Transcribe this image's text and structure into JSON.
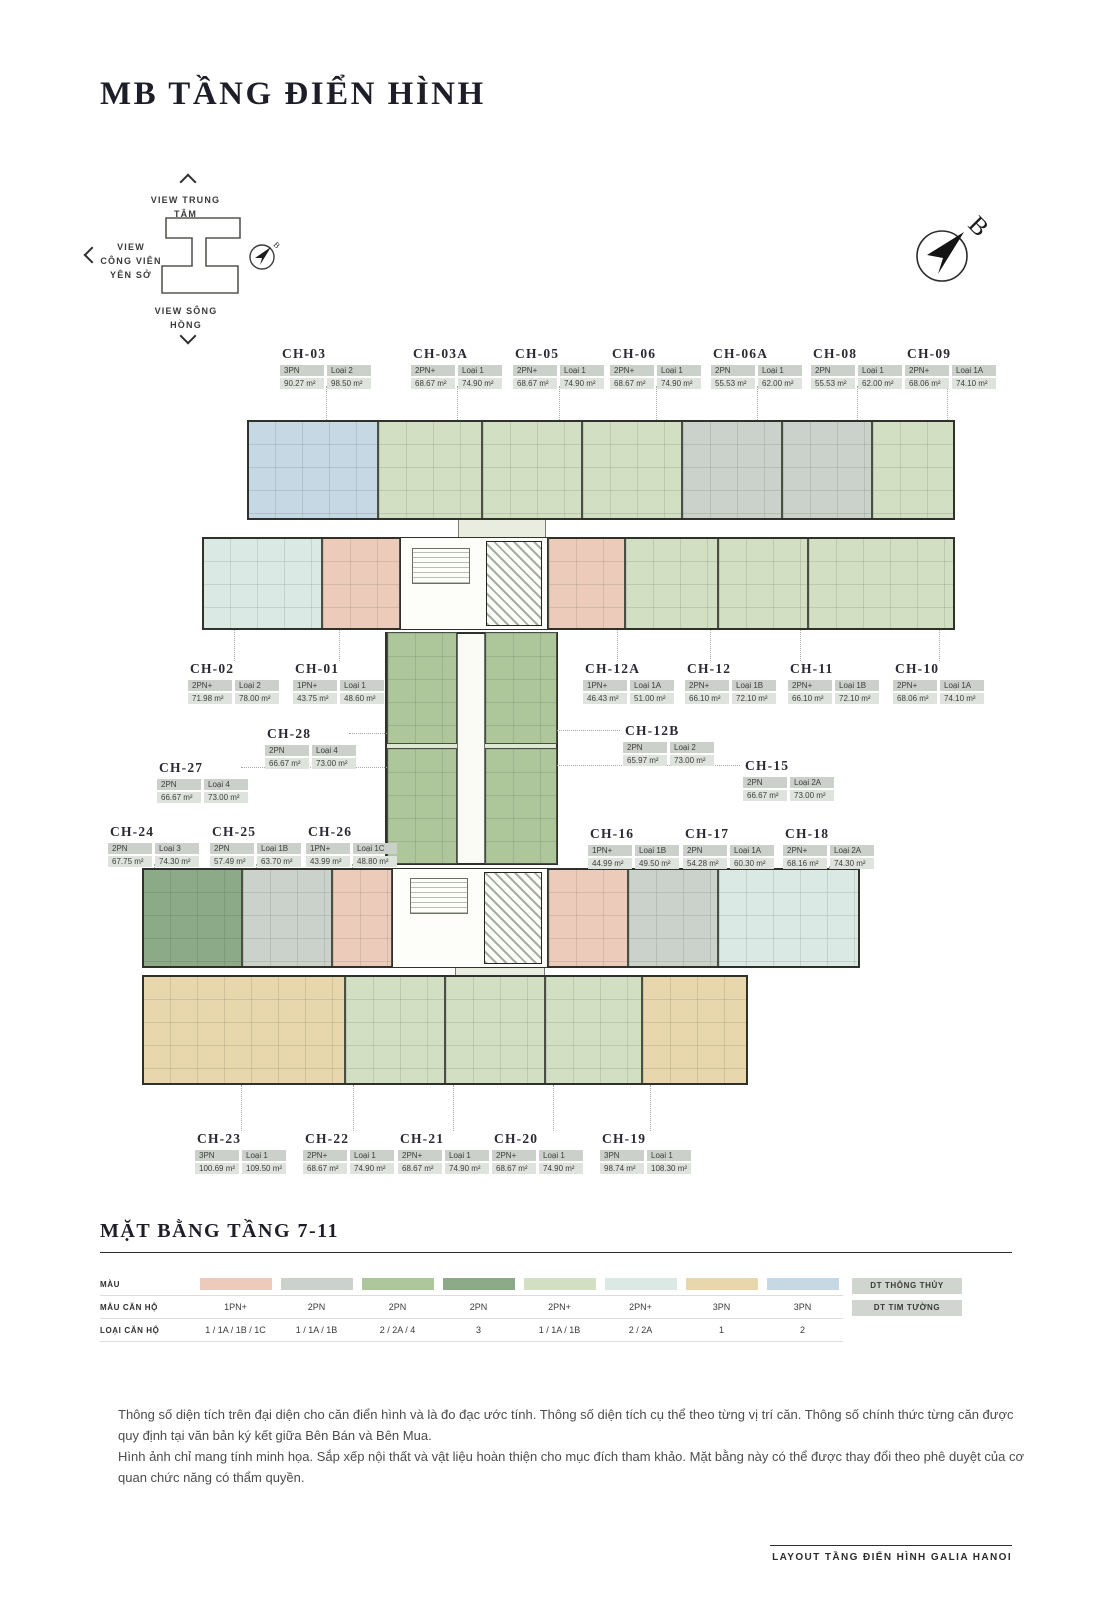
{
  "page": {
    "title": "MB TẦNG ĐIỂN HÌNH"
  },
  "orientation": {
    "view_top": "VIEW TRUNG TÂM",
    "view_left": "VIEW CÔNG VIÊN YÊN SỞ",
    "view_bottom": "VIEW SÔNG HỒNG",
    "north_label": "B"
  },
  "plan": {
    "colors": {
      "salmon": "#edcbba",
      "gray": "#cbd1cb",
      "green": "#adc79b",
      "dark_green": "#8caa88",
      "light_green": "#d2dfc2",
      "pale_cyan": "#dae9e3",
      "tan": "#e8d7ac",
      "light_blue": "#c6d8e4"
    },
    "connector_color": "#dfe8d3",
    "bands": [
      {
        "x": 247,
        "y": 420,
        "w": 708,
        "h": 100
      },
      {
        "x": 202,
        "y": 537,
        "w": 753,
        "h": 93
      },
      {
        "x": 142,
        "y": 868,
        "w": 718,
        "h": 100
      },
      {
        "x": 142,
        "y": 975,
        "w": 606,
        "h": 110
      }
    ],
    "connector": {
      "x": 385,
      "y": 632,
      "w": 173,
      "h": 233
    },
    "corridor": {
      "x": 457,
      "y": 634,
      "w": 28,
      "h": 229
    },
    "links": [
      {
        "x": 458,
        "y": 518,
        "w": 88,
        "h": 21
      },
      {
        "x": 455,
        "y": 961,
        "w": 90,
        "h": 16
      }
    ],
    "cores": [
      {
        "x": 400,
        "y": 537,
        "w": 148,
        "h": 93
      },
      {
        "x": 392,
        "y": 868,
        "w": 156,
        "h": 100
      }
    ],
    "stairs": [
      {
        "x": 412,
        "y": 548,
        "w": 58,
        "h": 36
      },
      {
        "x": 410,
        "y": 878,
        "w": 58,
        "h": 36
      }
    ],
    "elevators": [
      {
        "x": 486,
        "y": 541,
        "w": 56,
        "h": 85
      },
      {
        "x": 484,
        "y": 872,
        "w": 58,
        "h": 92
      }
    ]
  },
  "units": [
    {
      "id": "CH-03",
      "bed": "3PN",
      "loai": "Loại 2",
      "area_tt": "90.27 m²",
      "area_tim": "98.50 m²",
      "color": "light_blue",
      "label": {
        "x": 280,
        "y": 346
      },
      "block": {
        "x": 247,
        "y": 420,
        "w": 131,
        "h": 100
      }
    },
    {
      "id": "CH-03A",
      "bed": "2PN+",
      "loai": "Loại 1",
      "area_tt": "68.67 m²",
      "area_tim": "74.90 m²",
      "color": "light_green",
      "label": {
        "x": 411,
        "y": 346
      },
      "block": {
        "x": 378,
        "y": 420,
        "w": 104,
        "h": 100
      }
    },
    {
      "id": "CH-05",
      "bed": "2PN+",
      "loai": "Loại 1",
      "area_tt": "68.67 m²",
      "area_tim": "74.90 m²",
      "color": "light_green",
      "label": {
        "x": 513,
        "y": 346
      },
      "block": {
        "x": 482,
        "y": 420,
        "w": 100,
        "h": 100
      }
    },
    {
      "id": "CH-06",
      "bed": "2PN+",
      "loai": "Loại 1",
      "area_tt": "68.67 m²",
      "area_tim": "74.90 m²",
      "color": "light_green",
      "label": {
        "x": 610,
        "y": 346
      },
      "block": {
        "x": 582,
        "y": 420,
        "w": 100,
        "h": 100
      }
    },
    {
      "id": "CH-06A",
      "bed": "2PN",
      "loai": "Loại 1",
      "area_tt": "55.53 m²",
      "area_tim": "62.00 m²",
      "color": "gray",
      "label": {
        "x": 711,
        "y": 346
      },
      "block": {
        "x": 682,
        "y": 420,
        "w": 100,
        "h": 100
      }
    },
    {
      "id": "CH-08",
      "bed": "2PN",
      "loai": "Loại 1",
      "area_tt": "55.53 m²",
      "area_tim": "62.00 m²",
      "color": "gray",
      "label": {
        "x": 811,
        "y": 346
      },
      "block": {
        "x": 782,
        "y": 420,
        "w": 90,
        "h": 100
      }
    },
    {
      "id": "CH-09",
      "bed": "2PN+",
      "loai": "Loại 1A",
      "area_tt": "68.06 m²",
      "area_tim": "74.10 m²",
      "color": "light_green",
      "label": {
        "x": 905,
        "y": 346
      },
      "block": {
        "x": 872,
        "y": 420,
        "w": 83,
        "h": 100
      }
    },
    {
      "id": "CH-02",
      "bed": "2PN+",
      "loai": "Loại 2",
      "area_tt": "71.98 m²",
      "area_tim": "78.00 m²",
      "color": "pale_cyan",
      "label": {
        "x": 188,
        "y": 661
      },
      "block": {
        "x": 202,
        "y": 537,
        "w": 120,
        "h": 93
      }
    },
    {
      "id": "CH-01",
      "bed": "1PN+",
      "loai": "Loại 1",
      "area_tt": "43.75 m²",
      "area_tim": "48.60 m²",
      "color": "salmon",
      "label": {
        "x": 293,
        "y": 661
      },
      "block": {
        "x": 322,
        "y": 537,
        "w": 78,
        "h": 93
      }
    },
    {
      "id": "CH-12A",
      "bed": "1PN+",
      "loai": "Loại 1A",
      "area_tt": "46.43 m²",
      "area_tim": "51.00 m²",
      "color": "salmon",
      "label": {
        "x": 583,
        "y": 661
      },
      "block": {
        "x": 548,
        "y": 537,
        "w": 77,
        "h": 93
      }
    },
    {
      "id": "CH-12",
      "bed": "2PN+",
      "loai": "Loại 1B",
      "area_tt": "66.10 m²",
      "area_tim": "72.10 m²",
      "color": "light_green",
      "label": {
        "x": 685,
        "y": 661
      },
      "block": {
        "x": 625,
        "y": 537,
        "w": 93,
        "h": 93
      }
    },
    {
      "id": "CH-11",
      "bed": "2PN+",
      "loai": "Loại 1B",
      "area_tt": "66.10 m²",
      "area_tim": "72.10 m²",
      "color": "light_green",
      "label": {
        "x": 788,
        "y": 661
      },
      "block": {
        "x": 718,
        "y": 537,
        "w": 90,
        "h": 93
      }
    },
    {
      "id": "CH-10",
      "bed": "2PN+",
      "loai": "Loại 1A",
      "area_tt": "68.06 m²",
      "area_tim": "74.10 m²",
      "color": "light_green",
      "label": {
        "x": 893,
        "y": 661
      },
      "block": {
        "x": 808,
        "y": 537,
        "w": 147,
        "h": 93
      }
    },
    {
      "id": "CH-28",
      "bed": "2PN",
      "loai": "Loại 4",
      "area_tt": "66.67 m²",
      "area_tim": "73.00 m²",
      "color": "green",
      "label": {
        "x": 265,
        "y": 726
      },
      "block": {
        "x": 387,
        "y": 632,
        "w": 70,
        "h": 112
      }
    },
    {
      "id": "CH-12B",
      "bed": "2PN",
      "loai": "Loại 2",
      "area_tt": "65.97 m²",
      "area_tim": "73.00 m²",
      "color": "green",
      "label": {
        "x": 623,
        "y": 723
      },
      "block": {
        "x": 485,
        "y": 632,
        "w": 72,
        "h": 112
      }
    },
    {
      "id": "CH-27",
      "bed": "2PN",
      "loai": "Loại 4",
      "area_tt": "66.67 m²",
      "area_tim": "73.00 m²",
      "color": "green",
      "label": {
        "x": 157,
        "y": 760
      },
      "block": {
        "x": 387,
        "y": 748,
        "w": 70,
        "h": 116
      }
    },
    {
      "id": "CH-15",
      "bed": "2PN",
      "loai": "Loại 2A",
      "area_tt": "66.67 m²",
      "area_tim": "73.00 m²",
      "color": "green",
      "label": {
        "x": 743,
        "y": 758
      },
      "block": {
        "x": 485,
        "y": 748,
        "w": 72,
        "h": 116
      }
    },
    {
      "id": "CH-24",
      "bed": "2PN",
      "loai": "Loại 3",
      "area_tt": "67.75 m²",
      "area_tim": "74.30 m²",
      "color": "dark_green",
      "label": {
        "x": 108,
        "y": 824
      },
      "block": {
        "x": 142,
        "y": 868,
        "w": 100,
        "h": 100
      }
    },
    {
      "id": "CH-25",
      "bed": "2PN",
      "loai": "Loại 1B",
      "area_tt": "57.49 m²",
      "area_tim": "63.70 m²",
      "color": "gray",
      "label": {
        "x": 210,
        "y": 824
      },
      "block": {
        "x": 242,
        "y": 868,
        "w": 90,
        "h": 100
      }
    },
    {
      "id": "CH-26",
      "bed": "1PN+",
      "loai": "Loại 1C",
      "area_tt": "43.99 m²",
      "area_tim": "48.80 m²",
      "color": "salmon",
      "label": {
        "x": 306,
        "y": 824
      },
      "block": {
        "x": 332,
        "y": 868,
        "w": 60,
        "h": 100
      }
    },
    {
      "id": "CH-16",
      "bed": "1PN+",
      "loai": "Loại 1B",
      "area_tt": "44.99 m²",
      "area_tim": "49.50 m²",
      "color": "salmon",
      "label": {
        "x": 588,
        "y": 826
      },
      "block": {
        "x": 548,
        "y": 868,
        "w": 80,
        "h": 100
      }
    },
    {
      "id": "CH-17",
      "bed": "2PN",
      "loai": "Loại 1A",
      "area_tt": "54.28 m²",
      "area_tim": "60.30 m²",
      "color": "gray",
      "label": {
        "x": 683,
        "y": 826
      },
      "block": {
        "x": 628,
        "y": 868,
        "w": 90,
        "h": 100
      }
    },
    {
      "id": "CH-18",
      "bed": "2PN+",
      "loai": "Loại 2A",
      "area_tt": "68.16 m²",
      "area_tim": "74.30 m²",
      "color": "pale_cyan",
      "label": {
        "x": 783,
        "y": 826
      },
      "block": {
        "x": 718,
        "y": 868,
        "w": 142,
        "h": 100
      }
    },
    {
      "id": "CH-23",
      "bed": "3PN",
      "loai": "Loại 1",
      "area_tt": "100.69 m²",
      "area_tim": "109.50 m²",
      "color": "tan",
      "label": {
        "x": 195,
        "y": 1131
      },
      "block": {
        "x": 142,
        "y": 975,
        "w": 203,
        "h": 110
      }
    },
    {
      "id": "CH-22",
      "bed": "2PN+",
      "loai": "Loại 1",
      "area_tt": "68.67 m²",
      "area_tim": "74.90 m²",
      "color": "light_green",
      "label": {
        "x": 303,
        "y": 1131
      },
      "block": {
        "x": 345,
        "y": 975,
        "w": 100,
        "h": 110
      }
    },
    {
      "id": "CH-21",
      "bed": "2PN+",
      "loai": "Loại 1",
      "area_tt": "68.67 m²",
      "area_tim": "74.90 m²",
      "color": "light_green",
      "label": {
        "x": 398,
        "y": 1131
      },
      "block": {
        "x": 445,
        "y": 975,
        "w": 100,
        "h": 110
      }
    },
    {
      "id": "CH-20",
      "bed": "2PN+",
      "loai": "Loại 1",
      "area_tt": "68.67 m²",
      "area_tim": "74.90 m²",
      "color": "light_green",
      "label": {
        "x": 492,
        "y": 1131
      },
      "block": {
        "x": 545,
        "y": 975,
        "w": 97,
        "h": 110
      }
    },
    {
      "id": "CH-19",
      "bed": "3PN",
      "loai": "Loại 1",
      "area_tt": "98.74 m²",
      "area_tim": "108.30 m²",
      "color": "tan",
      "label": {
        "x": 600,
        "y": 1131
      },
      "block": {
        "x": 642,
        "y": 975,
        "w": 106,
        "h": 110
      }
    }
  ],
  "legend": {
    "title": "MẶT BẰNG TẦNG 7-11",
    "row_labels": [
      "MÀU",
      "MẪU CĂN HỘ",
      "LOẠI CĂN HỘ"
    ],
    "area_labels": [
      "DT THÔNG THỦY",
      "DT TIM TƯỜNG"
    ],
    "columns": [
      {
        "color": "salmon",
        "type": "1PN+",
        "loai": "1 / 1A / 1B / 1C"
      },
      {
        "color": "gray",
        "type": "2PN",
        "loai": "1 / 1A / 1B"
      },
      {
        "color": "green",
        "type": "2PN",
        "loai": "2 / 2A / 4"
      },
      {
        "color": "dark_green",
        "type": "2PN",
        "loai": "3"
      },
      {
        "color": "light_green",
        "type": "2PN+",
        "loai": "1 / 1A / 1B"
      },
      {
        "color": "pale_cyan",
        "type": "2PN+",
        "loai": "2 / 2A"
      },
      {
        "color": "tan",
        "type": "3PN",
        "loai": "1"
      },
      {
        "color": "light_blue",
        "type": "3PN",
        "loai": "2"
      }
    ]
  },
  "notes": {
    "p1": "Thông số diện tích trên đại diện cho căn điển hình và là đo đạc ước tính. Thông số diện tích cụ thể theo từng vị trí căn. Thông số chính thức từng căn được quy định tại văn bản ký kết giữa Bên Bán và Bên Mua.",
    "p2": "Hình ảnh chỉ mang tính minh họa. Sắp xếp nội thất và vật liệu hoàn thiện cho mục đích tham khảo. Mặt bằng này có thể được thay đổi theo phê duyệt của cơ quan chức năng có thẩm quyền."
  },
  "footer": {
    "label": "LAYOUT TẦNG ĐIỂN HÌNH GALIA HANOI"
  }
}
